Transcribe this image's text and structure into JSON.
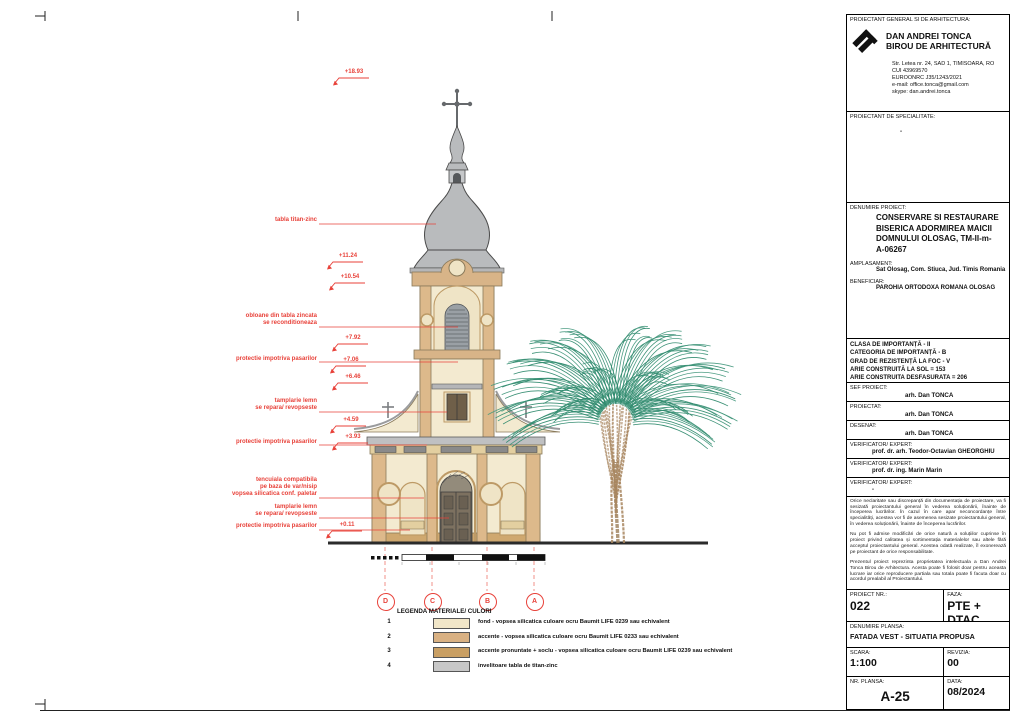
{
  "colors": {
    "annotation_red": "#e8423a",
    "facade_fond": "#f3ead0",
    "facade_accent": "#ddb98b",
    "facade_accent_strong": "#c99f63",
    "roof_zinc": "#b9bbbd",
    "tree_green": "#2f8a6e",
    "tree_brown": "#a8865f"
  },
  "drawing": {
    "annotations": [
      {
        "text": "tabla titan-zinc"
      },
      {
        "text": "obloane din tabla zincata\nse reconditioneaza"
      },
      {
        "text": "protectie impotriva pasarilor"
      },
      {
        "text": "tamplarie lemn\nse repara/ revopseste"
      },
      {
        "text": "protectie impotriva pasarilor"
      },
      {
        "text": "tencuiala compatibila\npe baza de var/nisip\nvopsea silicatica conf. paletar"
      },
      {
        "text": "tamplarie lemn\nse repara/ revopseste"
      },
      {
        "text": "protectie impotriva pasarilor"
      }
    ],
    "elevations": [
      "+18.93",
      "+11.24",
      "+10.54",
      "+7.92",
      "+7.06",
      "+6.46",
      "+4.59",
      "+3.93",
      "+0.11"
    ],
    "grid_bubbles": [
      "D",
      "C",
      "B",
      "A"
    ],
    "legend": {
      "title": "LEGENDA MATERIALE/ CULORI",
      "items": [
        {
          "num": "1",
          "color": "#f1e6c8",
          "label": "fond - vopsea silicatica culoare ocru Baumit LIFE 0239 sau echivalent"
        },
        {
          "num": "2",
          "color": "#d9b183",
          "label": "accente - vopsea silicatica culoare ocru Baumit LIFE 0233 sau echivalent"
        },
        {
          "num": "3",
          "color": "#c99f63",
          "label": "accente pronuntate + soclu - vopsea silicatica culoare ocru Baumit LIFE 0239 sau echivalent"
        },
        {
          "num": "4",
          "color": "#c7c7c7",
          "label": "invelitoare tabla de titan-zinc"
        }
      ]
    }
  },
  "titleblock": {
    "general_label": "PROIECTANT GENERAL SI DE ARHITECTURA:",
    "firm_name": "DAN ANDREI TONCA\nBIROU DE ARHITECTURĂ",
    "firm_address": "Str. Letea nr. 24, SAD 1, TIMISOARA, RO\nCUI 43969570\nEUROONRC J35/1243/2021\ne-mail: office.tonca@gmail.com\nskype: dan.andrei.tonca",
    "specialitate_label": "PROIECTANT DE SPECIALITATE:",
    "specialitate_value": "-",
    "denumire_label": "DENUMIRE PROIECT:",
    "denumire_value": "CONSERVARE SI RESTAURARE\nBISERICA ADORMIREA MAICII\nDOMNULUI OLOSAG, TM-II-m-\nA-06267",
    "amplasament_label": "AMPLASAMENT:",
    "amplasament_value": "Sat Olosag, Com. Stiuca, Jud. Timis Romania",
    "beneficiar_label": "BENEFICIAR:",
    "beneficiar_value": "PAROHIA ORTODOXA ROMANA OLOSAG",
    "info_lines": "CLASA DE IMPORTANȚĂ - II\nCATEGORIA DE IMPORTANȚĂ - B\nGRAD DE REZISTENȚĂ LA FOC - V\nARIE CONSTRUITĂ LA SOL = 153\nARIE CONSTRUITA DESFASURATA = 206",
    "roles": [
      {
        "label": "SEF PROIECT:",
        "value": "arh. Dan TONCA"
      },
      {
        "label": "PROIECTAT:",
        "value": "arh. Dan TONCA"
      },
      {
        "label": "DESENAT:",
        "value": "arh. Dan TONCA"
      },
      {
        "label": "VERIFICATOR/ EXPERT:",
        "value": "prof. dr. arh. Teodor-Octavian GHEORGHIU"
      },
      {
        "label": "VERIFICATOR/ EXPERT:",
        "value": "prof. dr. ing. Marin Marin"
      },
      {
        "label": "VERIFICATOR/ EXPERT:",
        "value": "-"
      }
    ],
    "disclaimer_1": "Orice neclaritate sau discrepanță din documentația de proiectare, va fi sesizată proiectantului general în vederea soluționării, înainte de începerea lucrărilor. În cazul în care apar neconcordanțe între specialități, acestea vor fi de asemenea sesizate proiectantului general, în vederea soluționării, înainte de începerea lucrărilor.",
    "disclaimer_2": "Nu pot fi admise modificări de orice natură a soluțiilor cuprinse în proiect privind calitatea și sortimentația materialelor sau altele fără acceptul proiectantului general. Acestea odată realizate, îl exonerează pe proiectant de orice responsabilitate.",
    "disclaimer_3": "Prezentul proiect reprezinta proprietatea intelectuala a Dan Andrei Tonca Birou de Arhitectura. Acesta poate fi folosit doar pentru aceasta lucrare iar orice reproducere partiala sau totala poate fi facuta doar cu acordul prealabil al Proiectantului.",
    "proiect_nr_label": "PROIECT NR.:",
    "proiect_nr": "022",
    "faza_label": "FAZA:",
    "faza": "PTE + DTAC",
    "plansa_label": "DENUMIRE PLANSA:",
    "plansa": "FATADA VEST - SITUATIA PROPUSA",
    "scara_label": "SCARA:",
    "scara": "1:100",
    "revizia_label": "REVIZIA:",
    "revizia": "00",
    "nr_plansa_label": "NR. PLANSA:",
    "nr_plansa": "A-25",
    "data_label": "DATA:",
    "data": "08/2024"
  }
}
